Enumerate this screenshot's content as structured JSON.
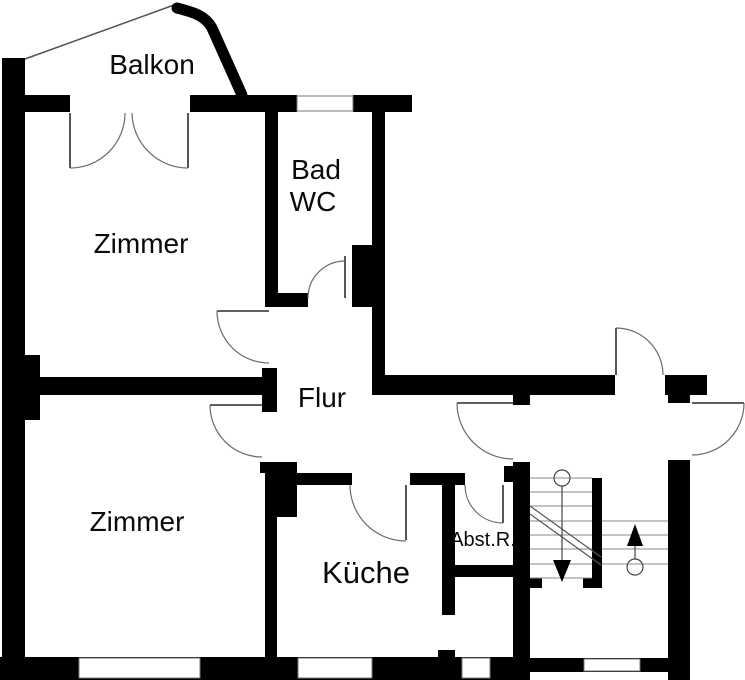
{
  "rooms": {
    "balkon": {
      "label": "Balkon"
    },
    "bad_wc": {
      "line1": "Bad",
      "line2": "WC"
    },
    "zimmer_upper": {
      "label": "Zimmer"
    },
    "zimmer_lower": {
      "label": "Zimmer"
    },
    "flur": {
      "label": "Flur"
    },
    "kueche": {
      "label": "Küche"
    },
    "abstellraum": {
      "label": "Abst.R."
    }
  },
  "colors": {
    "wall": "#000000",
    "background": "#ffffff",
    "door_arc": "#6b6b6b",
    "stair_line": "#8a8a8a"
  }
}
